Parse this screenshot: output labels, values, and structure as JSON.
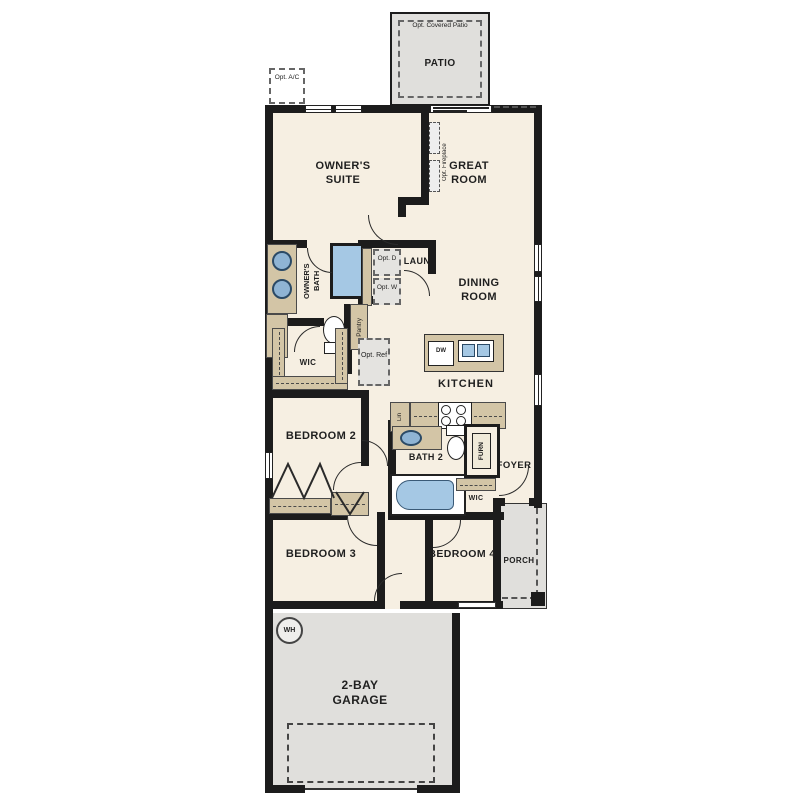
{
  "colors": {
    "wall": "#1c1c1c",
    "floor": "#f6efe2",
    "concrete": "#e0dfdc",
    "cabinet_tan": "#d3c5a6",
    "fixture_blue": "#a5c8e4"
  },
  "labels": {
    "patio": "PATIO",
    "opt_covered_patio": "Opt. Covered Patio",
    "opt_ac": "Opt. A/C",
    "owners_suite": "OWNER'S SUITE",
    "great_room": "GREAT ROOM",
    "opt_fireplace": "Opt. Fireplace",
    "owners_bath_line1": "OWNER'S",
    "owners_bath_line2": "BATH",
    "linen": "Linen",
    "laun": "LAUN",
    "opt_d": "Opt. D",
    "opt_w": "Opt. W",
    "dining_room": "DINING ROOM",
    "pantry": "Pantry",
    "opt_ref": "Opt. Ref",
    "wic": "WIC",
    "kitchen": "KITCHEN",
    "dw": "DW",
    "lin": "Lin",
    "bedroom2": "BEDROOM 2",
    "bath2": "BATH 2",
    "furn": "FURN",
    "foyer": "FOYER",
    "wic2": "WIC",
    "bedroom3": "BEDROOM 3",
    "bedroom4": "BEDROOM 4",
    "porch": "PORCH",
    "garage": "2-BAY GARAGE",
    "wh": "WH"
  }
}
